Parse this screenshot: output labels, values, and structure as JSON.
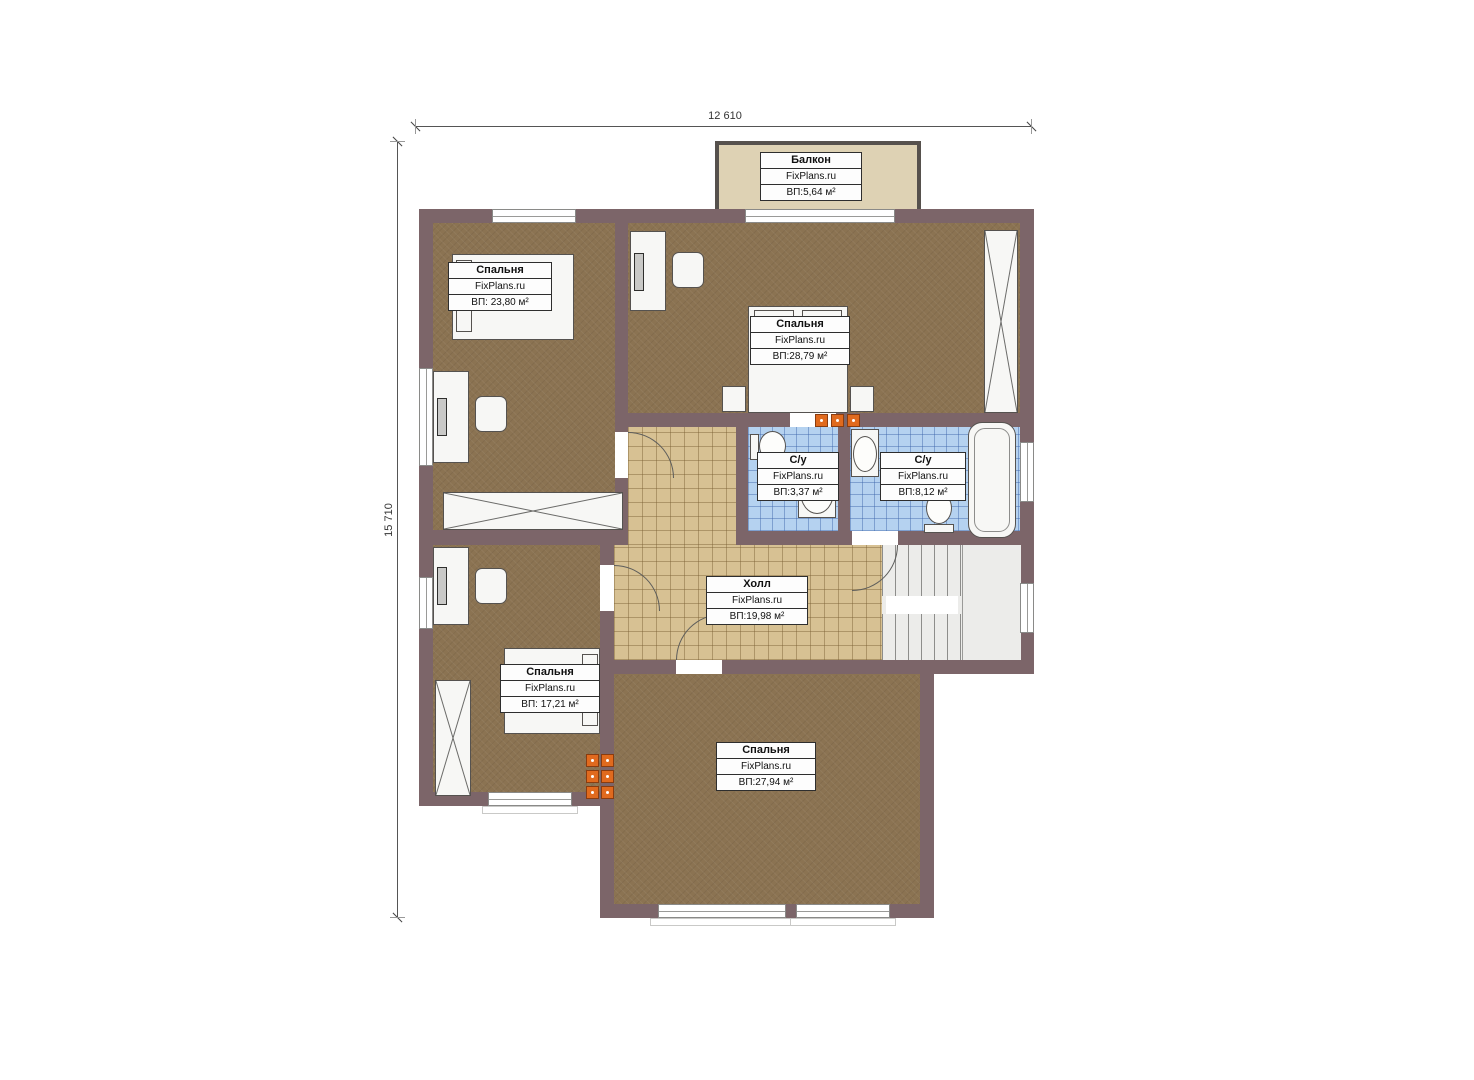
{
  "dimensions": {
    "top": "12 610",
    "left": "15 710"
  },
  "rooms": {
    "balcony": {
      "name": "Балкон",
      "brand": "FixPlans.ru",
      "area": "ВП:5,64 м²"
    },
    "bedroom_tl": {
      "name": "Спальня",
      "brand": "FixPlans.ru",
      "area": "ВП: 23,80 м²"
    },
    "bedroom_tr": {
      "name": "Спальня",
      "brand": "FixPlans.ru",
      "area": "ВП:28,79 м²"
    },
    "bath_small": {
      "name": "С/у",
      "brand": "FixPlans.ru",
      "area": "ВП:3,37 м²"
    },
    "bath_big": {
      "name": "С/у",
      "brand": "FixPlans.ru",
      "area": "ВП:8,12 м²"
    },
    "hall": {
      "name": "Холл",
      "brand": "FixPlans.ru",
      "area": "ВП:19,98 м²"
    },
    "bedroom_ml": {
      "name": "Спальня",
      "brand": "FixPlans.ru",
      "area": "ВП: 17,21 м²"
    },
    "bedroom_b": {
      "name": "Спальня",
      "brand": "FixPlans.ru",
      "area": "ВП:27,94 м²"
    }
  },
  "colors": {
    "wall": "#7c6569",
    "bedroom_floor": "#8b7352",
    "hall_floor": "#d7c193",
    "bath_floor": "#b5d2f0",
    "balcony_floor": "#ded2b4",
    "stairs_floor": "#ececea",
    "radiator": "#e06a1e",
    "background": "#ffffff"
  }
}
